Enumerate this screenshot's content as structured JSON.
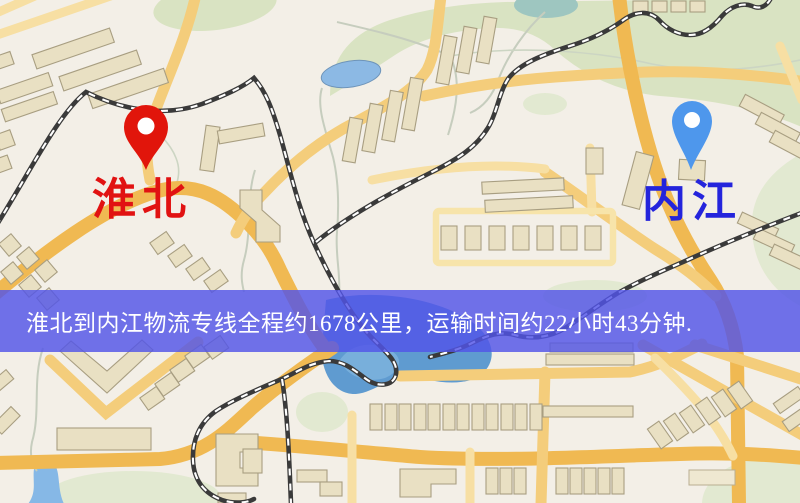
{
  "origin": {
    "label": "淮北"
  },
  "destination": {
    "label": "内江"
  },
  "banner": {
    "text": "淮北到内江物流专线全程约1678公里，运输时间约22小时43分钟."
  },
  "route": {
    "distance_km": "1678",
    "duration_hours": "22",
    "duration_minutes": "43"
  },
  "colors": {
    "origin_pin": "#e81309",
    "origin_label": "#e11212",
    "destination_pin": "#4b97f0",
    "destination_label": "#2424dc",
    "banner_bg": "rgba(82,84,232,0.82)",
    "banner_text": "#ffffff",
    "map_background": "#f3efe7",
    "road_main": "#f2b94e",
    "water": "#5d9bd3",
    "park": "#d9e3c1"
  }
}
